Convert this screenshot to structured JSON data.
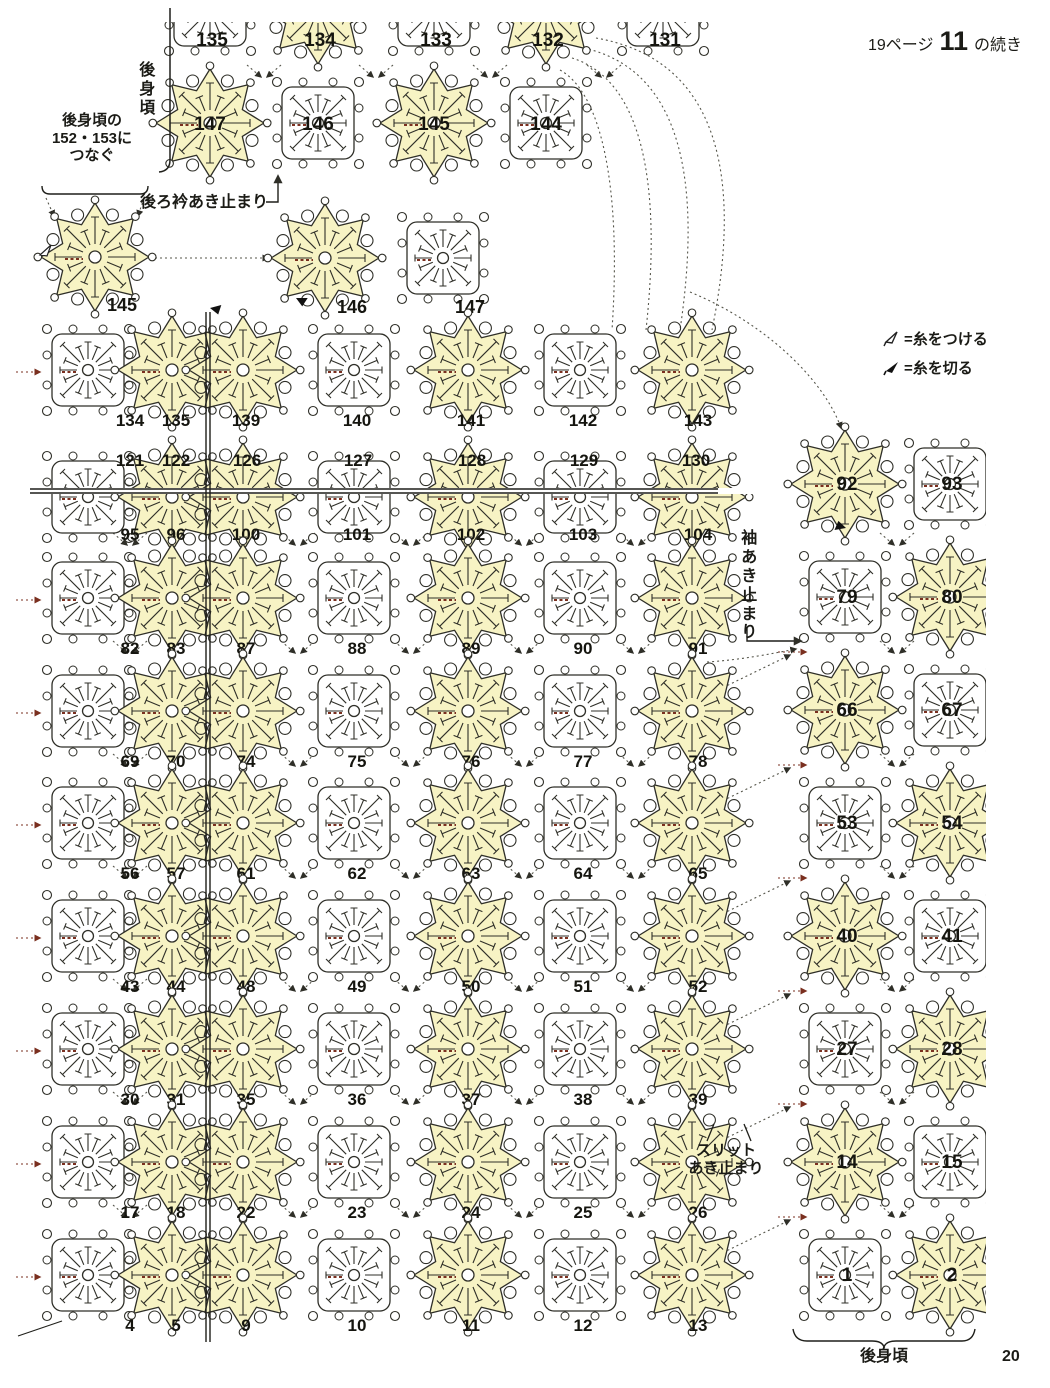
{
  "header": {
    "page_ref": "19ページ",
    "bold_ref": "11",
    "suffix": "の続き"
  },
  "page": {
    "number": "20"
  },
  "legend": {
    "attach": {
      "symbol": "attach-flag",
      "label": "=糸をつける"
    },
    "cut": {
      "symbol": "cut-triangle",
      "label": "=糸を切る"
    }
  },
  "annotations": {
    "back_body_top": "後身頃",
    "connect_note_lines": [
      "後身頃の",
      "152・153に",
      "つなぐ"
    ],
    "back_collar_stop": "後ろ衿あき止まり",
    "sleeve_stop": "袖あき止まり",
    "slit_stop_lines": [
      "スリット",
      "あき止まり"
    ],
    "back_body_bottom": "後身頃"
  },
  "colors": {
    "motif_yellow": "#f7f3c4",
    "ink": "#2f2f28",
    "red_mark": "#7a2f1f",
    "dots": "#55554a"
  },
  "diagram": {
    "main_grid": {
      "col_x": [
        88,
        172,
        243,
        354,
        468,
        580,
        692
      ],
      "col_types": [
        "sq",
        "st",
        "st",
        "sq",
        "st",
        "sq",
        "st"
      ],
      "label_dx": [
        42,
        4,
        3,
        3,
        3,
        3,
        6
      ],
      "rows": [
        {
          "y": 370,
          "mode": "below",
          "labels": [
            "134",
            "135",
            "139",
            "140",
            "141",
            "142",
            "143"
          ]
        },
        {
          "y": 497,
          "mode": "inside-top",
          "clip": "above-line",
          "labels": [
            "121",
            "122",
            "126",
            "127",
            "128",
            "129",
            "130"
          ]
        },
        {
          "y": 497,
          "mode": "below-near",
          "clip": "below-line",
          "labels": [
            "95",
            "96",
            "100",
            "101",
            "102",
            "103",
            "104"
          ]
        },
        {
          "y": 598,
          "mode": "below",
          "labels": [
            "82",
            "83",
            "87",
            "88",
            "89",
            "90",
            "91"
          ]
        },
        {
          "y": 711,
          "mode": "below",
          "labels": [
            "69",
            "70",
            "74",
            "75",
            "76",
            "77",
            "78"
          ]
        },
        {
          "y": 823,
          "mode": "below",
          "labels": [
            "56",
            "57",
            "61",
            "62",
            "63",
            "64",
            "65"
          ]
        },
        {
          "y": 936,
          "mode": "below",
          "labels": [
            "43",
            "44",
            "48",
            "49",
            "50",
            "51",
            "52"
          ]
        },
        {
          "y": 1049,
          "mode": "below",
          "labels": [
            "30",
            "31",
            "35",
            "36",
            "37",
            "38",
            "39"
          ]
        },
        {
          "y": 1162,
          "mode": "below",
          "labels": [
            "17",
            "18",
            "22",
            "23",
            "24",
            "25",
            "26"
          ]
        },
        {
          "y": 1275,
          "mode": "below",
          "labels": [
            "4",
            "5",
            "9",
            "10",
            "11",
            "12",
            "13"
          ]
        }
      ]
    },
    "top_section": {
      "rows": [
        {
          "y": 10,
          "mode": "inside-top",
          "clip": "top-edge",
          "cols": [
            {
              "x": 210,
              "t": "sq",
              "n": "135"
            },
            {
              "x": 318,
              "t": "st",
              "n": "134"
            },
            {
              "x": 434,
              "t": "sq",
              "n": "133"
            },
            {
              "x": 546,
              "t": "st",
              "n": "132"
            },
            {
              "x": 663,
              "t": "sq",
              "n": "131"
            }
          ]
        },
        {
          "y": 123,
          "mode": "inside",
          "cols": [
            {
              "x": 210,
              "t": "st",
              "n": "147"
            },
            {
              "x": 318,
              "t": "sq",
              "n": "146"
            },
            {
              "x": 434,
              "t": "st",
              "n": "145"
            },
            {
              "x": 546,
              "t": "sq",
              "n": "144"
            }
          ]
        }
      ]
    },
    "detached": [
      {
        "x": 95,
        "y": 257,
        "t": "st",
        "n": "145",
        "nx": 122,
        "ny": 311
      },
      {
        "x": 325,
        "y": 258,
        "t": "st",
        "n": "146",
        "nx": 352,
        "ny": 313
      },
      {
        "x": 443,
        "y": 258,
        "t": "sq",
        "n": "147",
        "nx": 470,
        "ny": 313
      }
    ],
    "right_column": {
      "col_x": [
        845,
        950
      ],
      "rows": [
        {
          "y": 484,
          "types": [
            "st",
            "sq"
          ],
          "labels": [
            "92",
            "93"
          ]
        },
        {
          "y": 597,
          "types": [
            "sq",
            "st"
          ],
          "labels": [
            "79",
            "80"
          ]
        },
        {
          "y": 710,
          "types": [
            "st",
            "sq"
          ],
          "labels": [
            "66",
            "67"
          ]
        },
        {
          "y": 823,
          "types": [
            "sq",
            "st"
          ],
          "labels": [
            "53",
            "54"
          ]
        },
        {
          "y": 936,
          "types": [
            "st",
            "sq"
          ],
          "labels": [
            "40",
            "41"
          ]
        },
        {
          "y": 1049,
          "types": [
            "sq",
            "st"
          ],
          "labels": [
            "27",
            "28"
          ]
        },
        {
          "y": 1162,
          "types": [
            "st",
            "sq"
          ],
          "labels": [
            "14",
            "15"
          ]
        },
        {
          "y": 1275,
          "types": [
            "sq",
            "st"
          ],
          "labels": [
            "1",
            "2"
          ]
        }
      ]
    }
  }
}
